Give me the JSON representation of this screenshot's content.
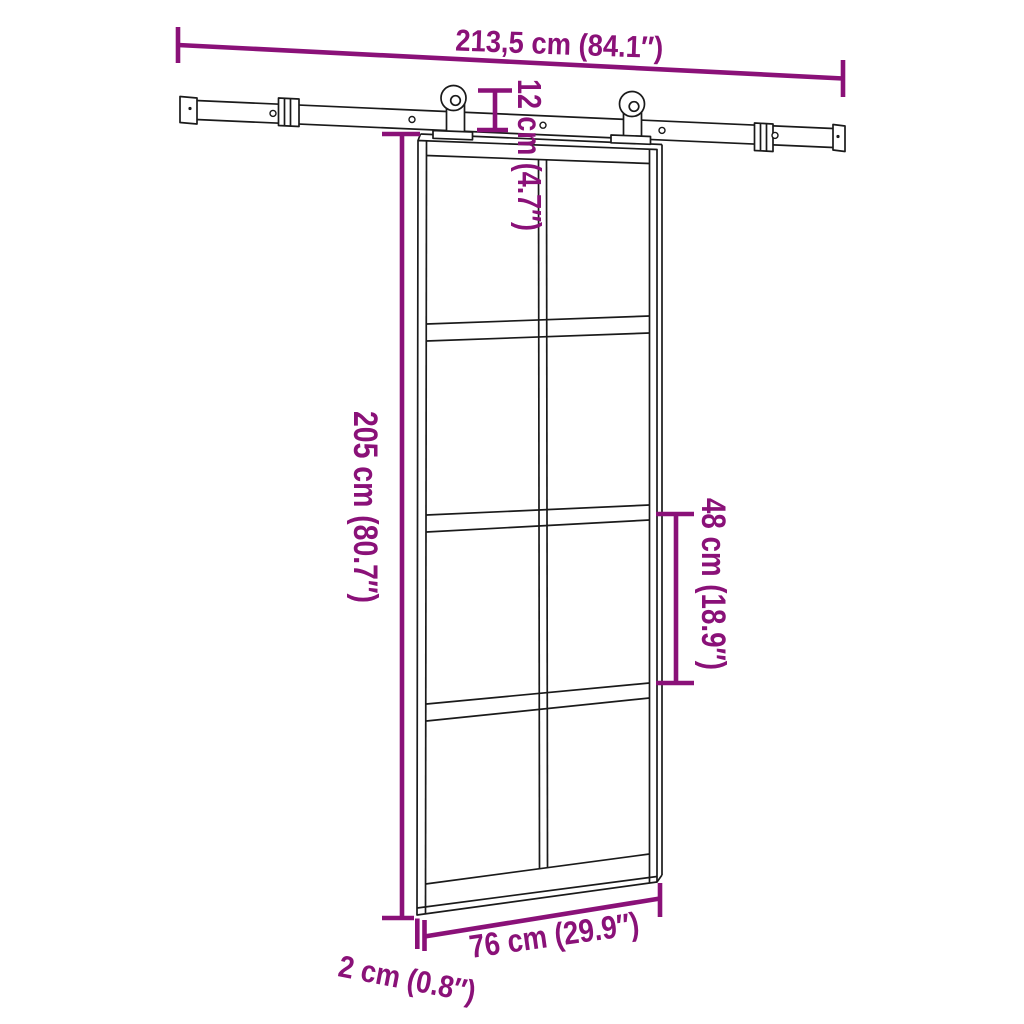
{
  "colors": {
    "background": "#FFFFFF",
    "line_art": "#1A1A1A",
    "dimension_annotation": "#8A1178"
  },
  "annotations": {
    "rail_length": "213,5 cm (84.1″)",
    "hanger_height": "12 cm (4.7″)",
    "door_height": "205 cm (80.7″)",
    "panel_height": "48 cm (18.9″)",
    "door_width": "76 cm (29.9″)",
    "door_thickness": "2 cm (0.8″)"
  }
}
